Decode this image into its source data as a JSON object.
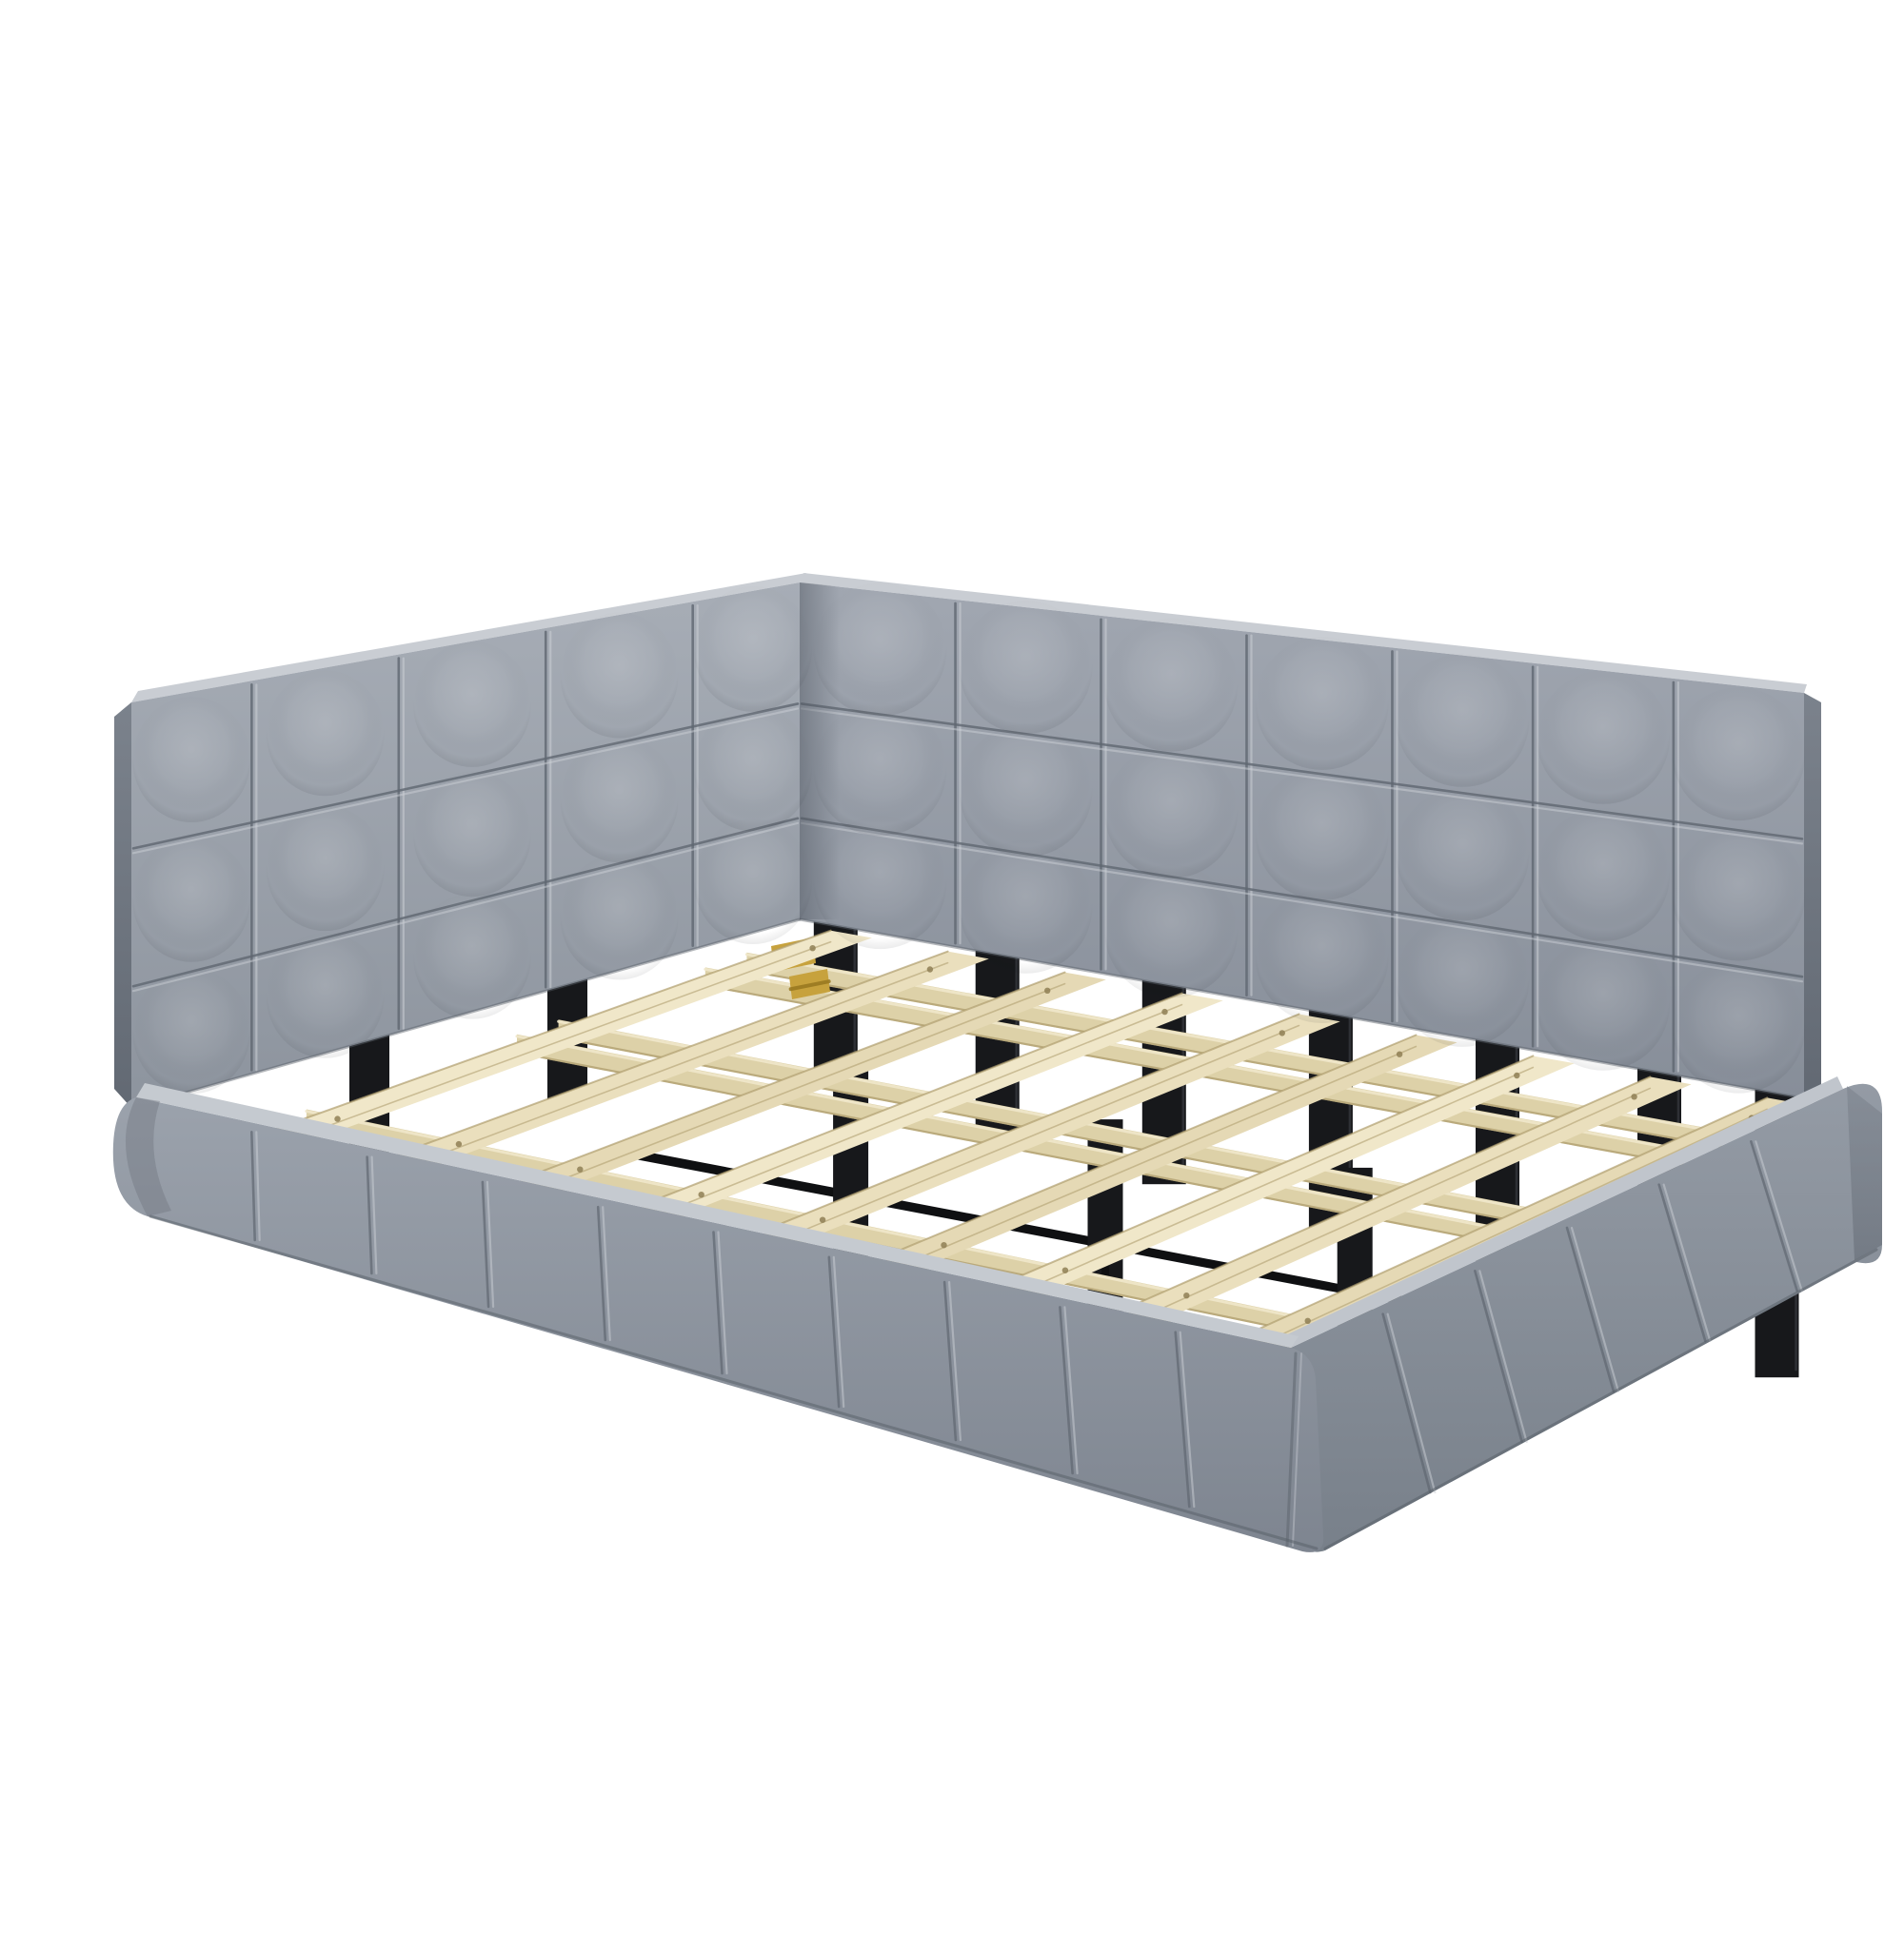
{
  "meta": {
    "background": "#ffffff"
  },
  "scene": {
    "description": "Product photo of a gray velvet upholstered platform daybed with an L-shaped square-tufted backrest (headboard panel and long back panel), low channel-tufted upholstered base rails, a natural pine wood slat deck resting on a black metal support frame with brass folding hinges, on a plain white background",
    "object_type": "upholstered daybed frame",
    "fabric": {
      "material": "gray velvet",
      "base": "#949aa4",
      "light": "#a8aeb7",
      "dark": "#868d98",
      "panel_top": "#c9cdd3",
      "side_face_dark": "#6e757f",
      "seam_dark": "#5f6670",
      "seam_light": "#ccd0d6"
    },
    "wood": {
      "material": "natural pine slats",
      "top": "#efe5c5",
      "face": "#d9cba0",
      "edge": "#b1a071",
      "end": "#e6dbb6",
      "support": "#ddd1a8",
      "screw": "#8f7f55"
    },
    "metal": {
      "material": "black steel support frame",
      "leg": "#17181b",
      "bar": "#0f1012",
      "highlight": "#35373c"
    },
    "hardware": {
      "material": "brass hinge",
      "gold": "#c7a23d",
      "gold_dark": "#97771f"
    },
    "headboard": {
      "tuft_columns": 5,
      "tuft_rows": 3,
      "column_seams": 4,
      "row_seams": 2
    },
    "back_panel": {
      "tuft_columns": 7,
      "tuft_rows": 3,
      "column_seams": 6,
      "row_seams": 2
    },
    "front_rail": {
      "channels": 10,
      "seams": 9
    },
    "foot_rail": {
      "channels": 6,
      "seams": 5
    },
    "slats": {
      "count": 9
    },
    "support_rails": {
      "count": 5
    },
    "legs": {
      "back": 7,
      "middle": 3,
      "head": 2
    },
    "hinges": {
      "count": 2
    }
  }
}
